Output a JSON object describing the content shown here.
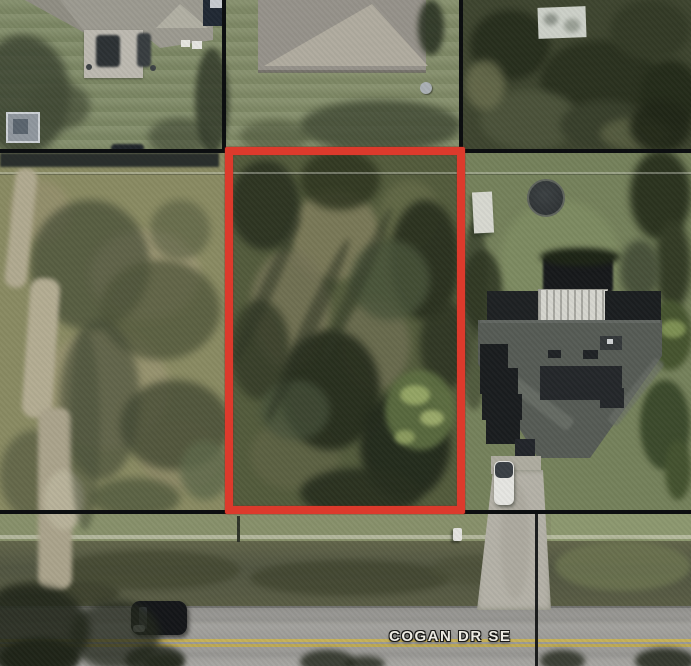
{
  "map": {
    "type": "aerial-parcel-view",
    "street_label": "COGAN DR SE",
    "subject_outline_color": "#dc3a2c",
    "parcel_line_color": "#0c0e10",
    "road_surface_color": "#a09f9b",
    "road_centerline_color": "#c8b255"
  }
}
